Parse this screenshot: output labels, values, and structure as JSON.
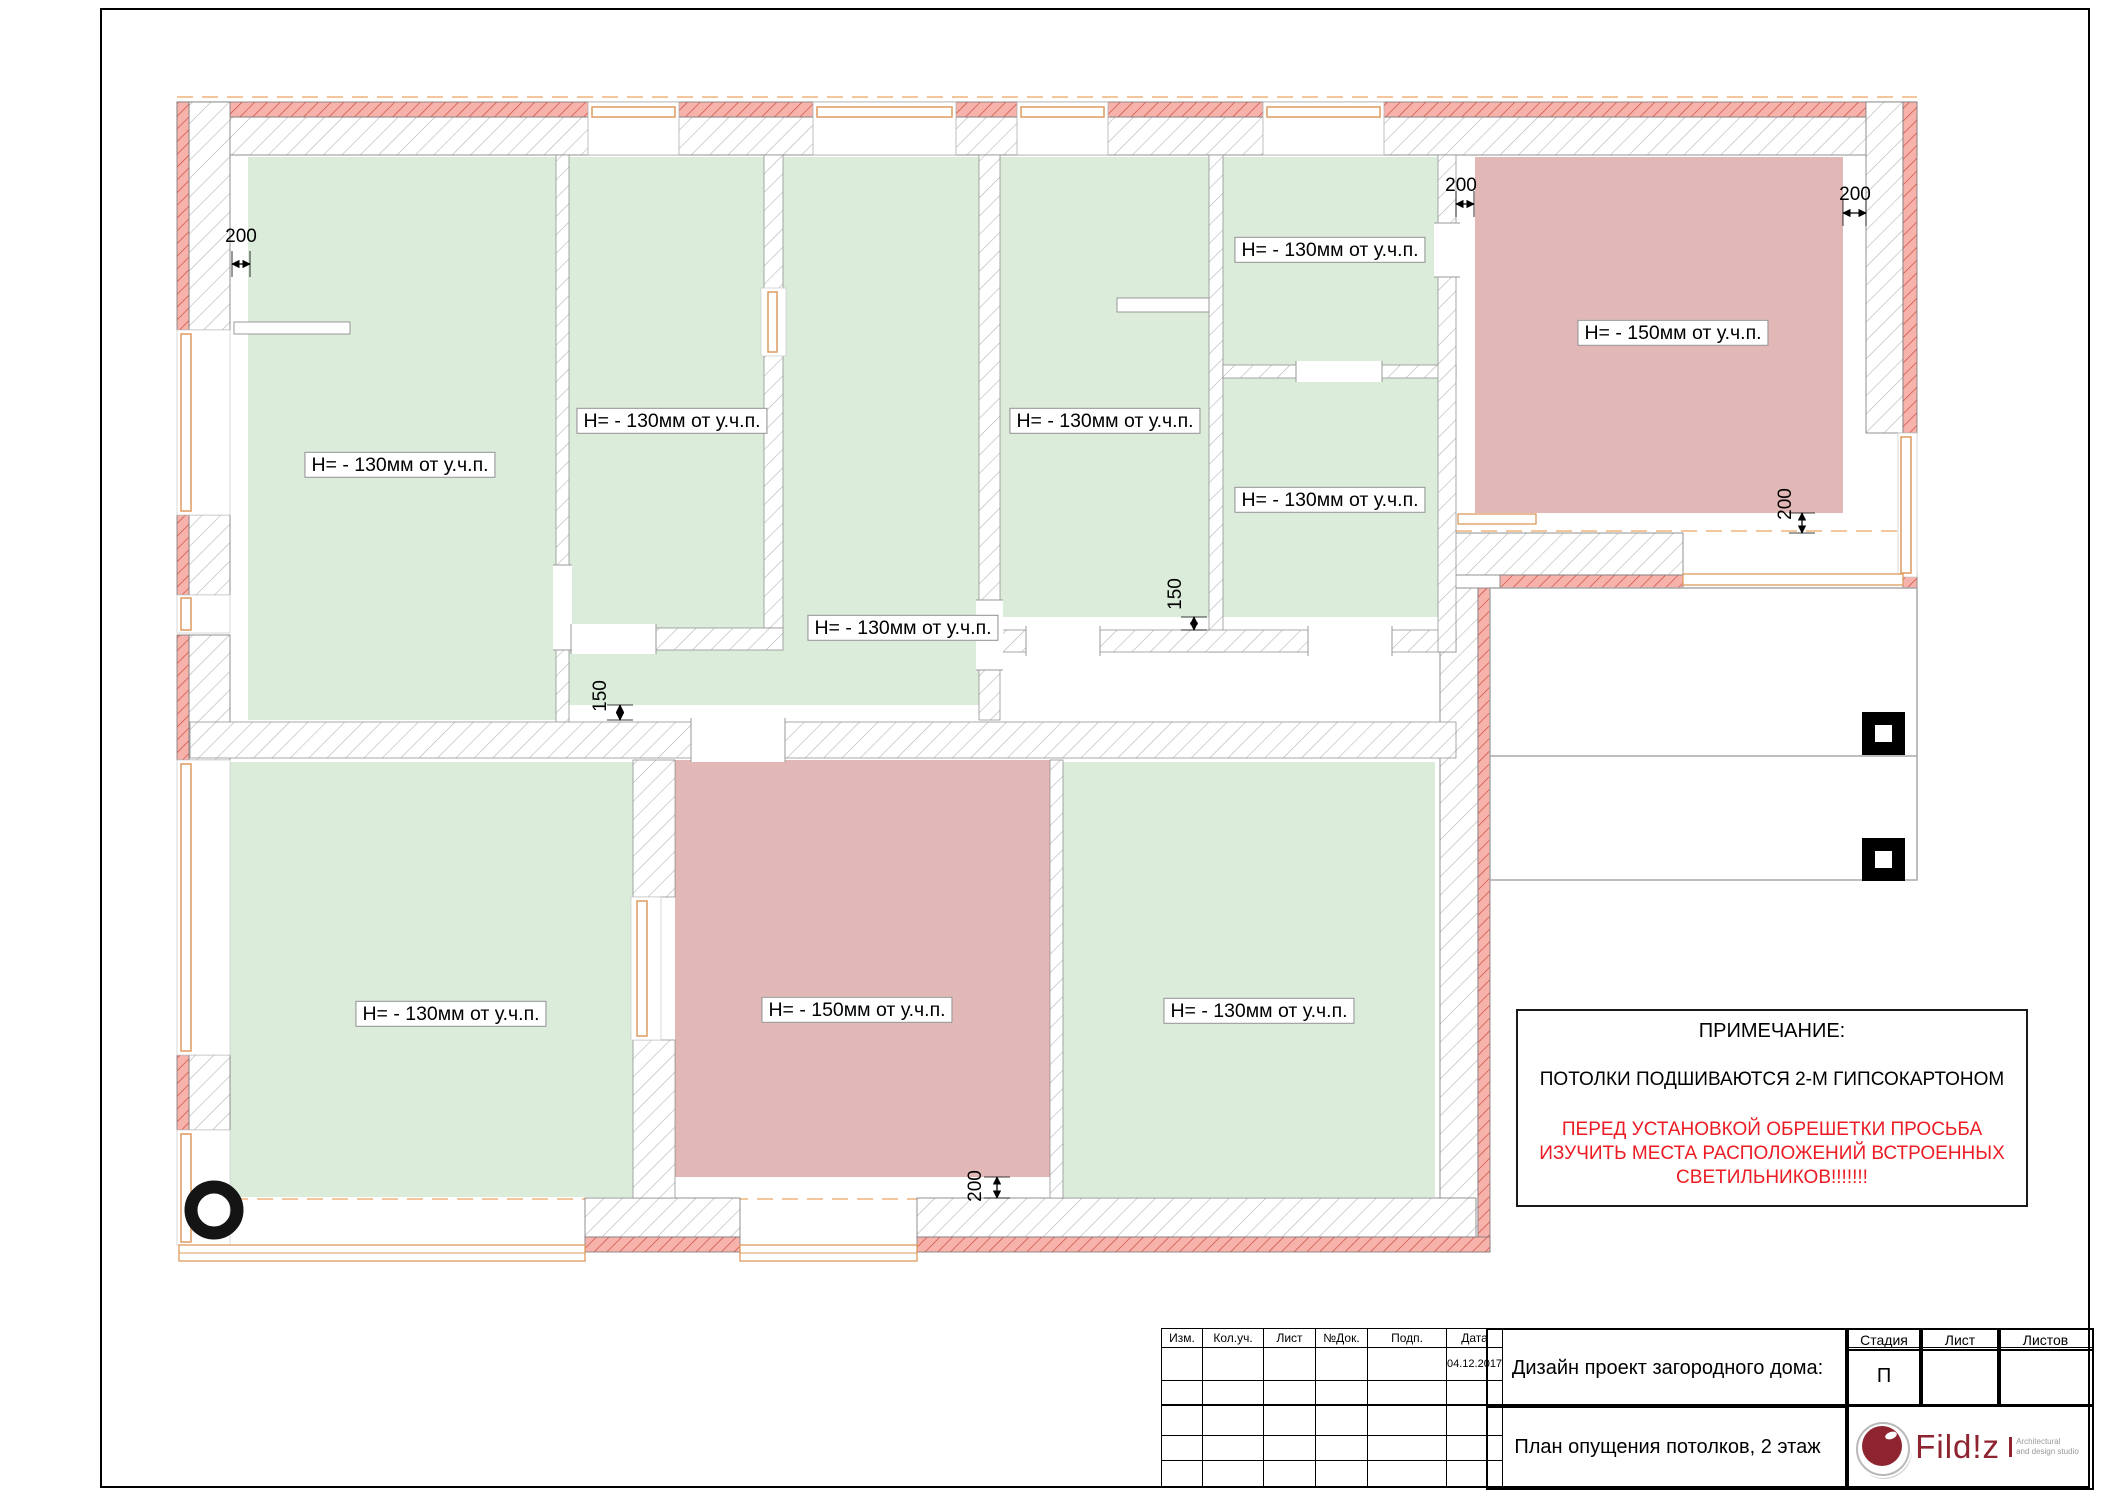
{
  "plan": {
    "labels": [
      {
        "room": "top-left",
        "text": "Н= - 130мм  от у.ч.п."
      },
      {
        "room": "top-second",
        "text": "Н= - 130мм  от у.ч.п."
      },
      {
        "room": "center-right",
        "text": "Н= - 130мм  от у.ч.п."
      },
      {
        "room": "right-small-upper",
        "text": "Н= - 130мм  от у.ч.п."
      },
      {
        "room": "right-small-lower",
        "text": "Н= - 130мм  от у.ч.п."
      },
      {
        "room": "central-hall",
        "text": "Н= - 130мм  от у.ч.п."
      },
      {
        "room": "top-right-pink",
        "text": "Н= - 150мм  от у.ч.п."
      },
      {
        "room": "bottom-left",
        "text": "Н= - 130мм  от у.ч.п."
      },
      {
        "room": "bottom-center-pink",
        "text": "Н= - 150мм  от у.ч.п."
      },
      {
        "room": "bottom-right",
        "text": "Н= - 130мм  от у.ч.п."
      }
    ],
    "dims": [
      {
        "loc": "top-left",
        "value": "200"
      },
      {
        "loc": "top-middle",
        "value": "200"
      },
      {
        "loc": "top-right",
        "value": "200"
      },
      {
        "loc": "right-vertical",
        "value": "200"
      },
      {
        "loc": "mid-left-150",
        "value": "150"
      },
      {
        "loc": "mid-right-150",
        "value": "150"
      },
      {
        "loc": "bottom-vertical",
        "value": "200"
      }
    ]
  },
  "note": {
    "title": "ПРИМЕЧАНИЕ:",
    "line1": "ПОТОЛКИ ПОДШИВАЮТСЯ 2-М ГИПСОКАРТОНОМ",
    "warn1": "ПЕРЕД УСТАНОВКОЙ ОБРЕШЕТКИ ПРОСЬБА",
    "warn2": "ИЗУЧИТЬ МЕСТА РАСПОЛОЖЕНИЙ ВСТРОЕННЫХ",
    "warn3": "СВЕТИЛЬНИКОВ!!!!!!!"
  },
  "titleblock": {
    "headers": {
      "izm": "Изм.",
      "koluch": "Кол.уч.",
      "list": "Лист",
      "ndok": "№Док.",
      "podp": "Подп.",
      "data": "Дата",
      "stadia": "Стадия",
      "list2": "Лист",
      "listov": "Листов"
    },
    "date": "04.12.2017",
    "stage": "П",
    "project_title": "Дизайн проект загородного дома:",
    "drawing_title": "План опущения потолков, 2 этаж"
  },
  "logo": {
    "name": "Fild!z",
    "tagline1": "Architectural",
    "tagline2": "and design studio"
  },
  "colors": {
    "ceiling_green": "#dbecdb",
    "ceiling_pink": "#e2b8b6",
    "wall_red_hatch": "#f7b3ab",
    "note_warning_red": "#ec1c24",
    "window_orange": "#dd9b5e",
    "logo_maroon": "#8e2430"
  }
}
